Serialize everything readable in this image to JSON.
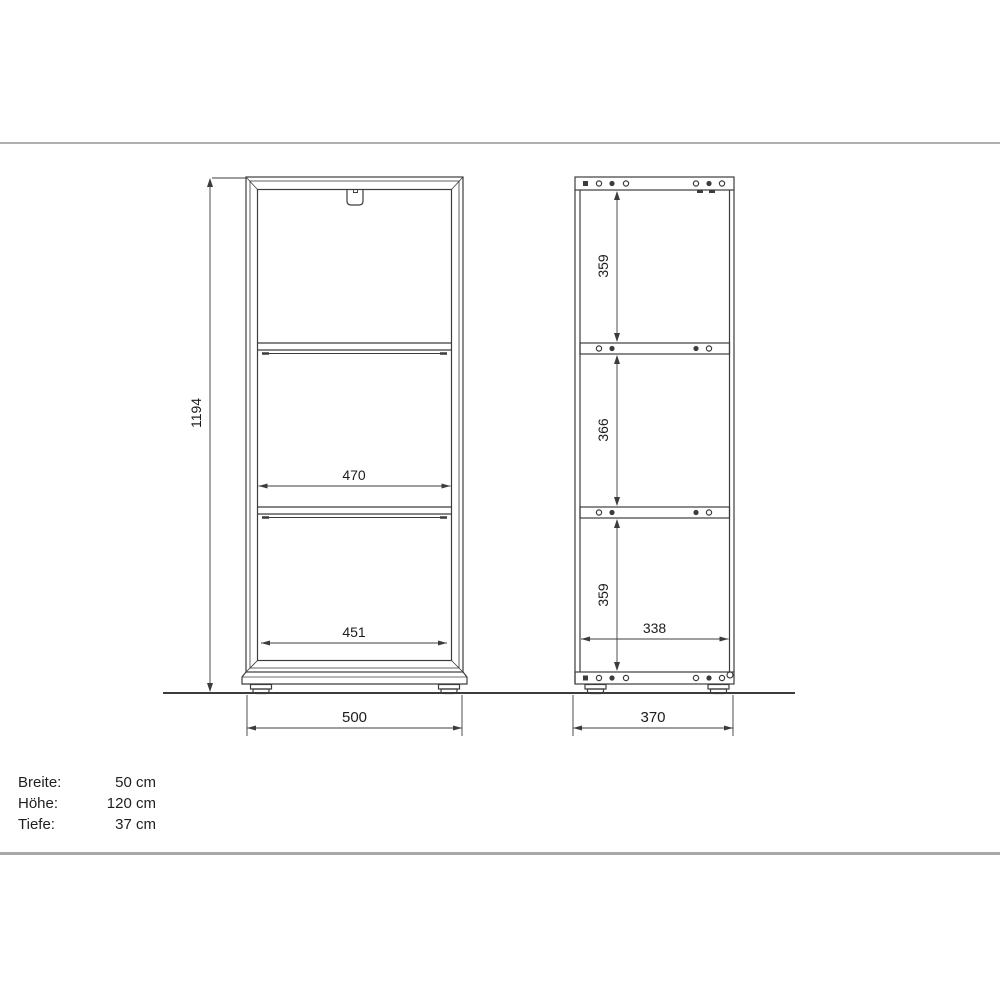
{
  "views": {
    "front": {
      "overall_height": "1194",
      "shelf_clear_width": "470",
      "bottom_clear_width": "451",
      "overall_width": "500"
    },
    "side": {
      "top_compartment_height": "359",
      "middle_compartment_height": "366",
      "bottom_compartment_height": "359",
      "inner_depth": "338",
      "overall_depth": "370"
    }
  },
  "spec_panel": {
    "rows": [
      {
        "label": "Breite:",
        "value": "50 cm"
      },
      {
        "label": "Höhe:",
        "value": "120 cm"
      },
      {
        "label": "Tiefe:",
        "value": "37 cm"
      }
    ]
  },
  "colors": {
    "line": "#3c3c3c",
    "separator": "#b0b0b0",
    "background": "#ffffff"
  }
}
